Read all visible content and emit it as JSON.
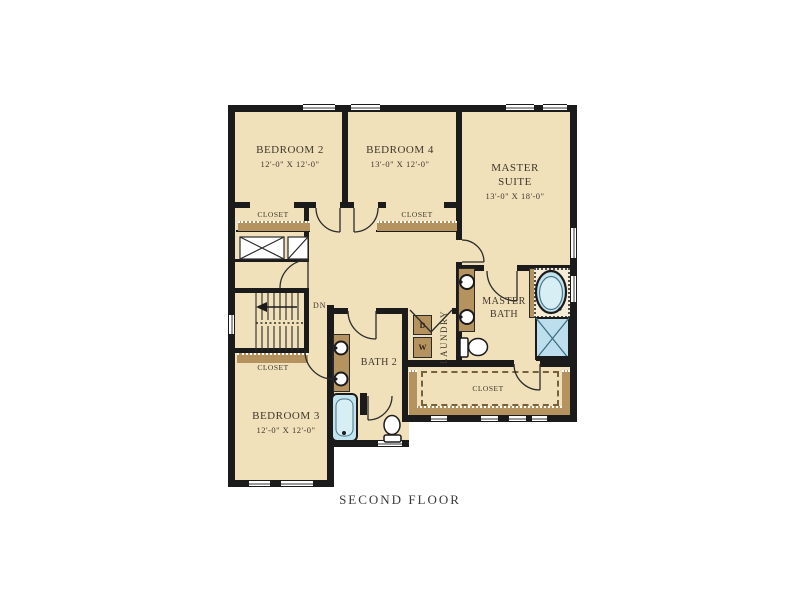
{
  "title": "SECOND FLOOR",
  "colors": {
    "floor": "#f0e1ba",
    "wall": "#1b1b1b",
    "counter_brown": "#b4935f",
    "fixture_blue": "#c3e3ee",
    "text": "#3f372c"
  },
  "rooms": {
    "bedroom2": {
      "name": "BEDROOM 2",
      "dims": "12'-0\" X 12'-0\""
    },
    "bedroom4": {
      "name": "BEDROOM 4",
      "dims": "13'-0\" X 12'-0\""
    },
    "master_suite": {
      "line1": "MASTER",
      "line2": "SUITE",
      "dims": "13'-0\" X 18'-0\""
    },
    "bedroom3": {
      "name": "BEDROOM 3",
      "dims": "12'-0\" X 12'-0\""
    },
    "bath2": {
      "name": "BATH 2"
    },
    "master_bath": {
      "line1": "MASTER",
      "line2": "BATH"
    },
    "laundry": {
      "name": "LAUNDRY",
      "dryer": "D",
      "washer": "W"
    },
    "stairs": {
      "direction": "DN"
    }
  },
  "closets": {
    "bedroom2_closet": "CLOSET",
    "bedroom4_closet": "CLOSET",
    "bedroom3_closet": "CLOSET",
    "walk_in_closet": "CLOSET"
  }
}
